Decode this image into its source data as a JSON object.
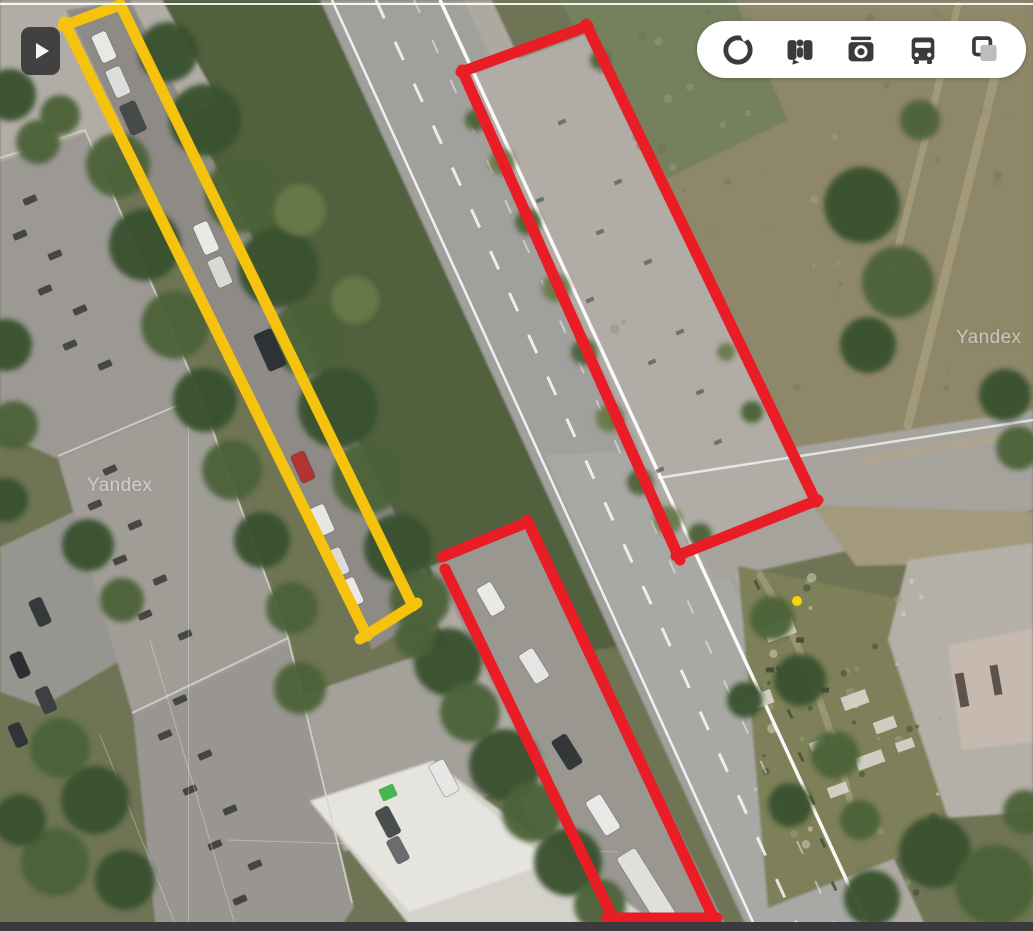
{
  "ui": {
    "play_button": {
      "name": "expand-panel-button",
      "x": 21,
      "y": 27
    },
    "toolbar": {
      "icons": [
        {
          "name": "panorama-ring-icon"
        },
        {
          "name": "street-view-icon"
        },
        {
          "name": "photos-camera-icon"
        },
        {
          "name": "transport-bus-icon"
        },
        {
          "name": "layers-icon"
        }
      ]
    },
    "watermarks": [
      {
        "text": "Yandex",
        "x": 87,
        "y": 475
      },
      {
        "text": "Yandex",
        "x": 956,
        "y": 327
      }
    ]
  },
  "annotations": {
    "stroke_width": 11,
    "yellow": "#f5c20e",
    "red": "#ea1c25",
    "rectangles": [
      {
        "id": "yellow-parking-strip",
        "color": "#f5c20e",
        "segments": [
          [
            63,
            26,
            120,
            5
          ],
          [
            120,
            4,
            413,
            606
          ],
          [
            417,
            603,
            360,
            639
          ],
          [
            64,
            22,
            367,
            636
          ]
        ]
      },
      {
        "id": "red-concrete-pad",
        "color": "#ea1c25",
        "segments": [
          [
            461,
            72,
            588,
            26
          ],
          [
            586,
            24,
            816,
            502
          ],
          [
            818,
            500,
            676,
            556
          ],
          [
            462,
            70,
            680,
            560
          ]
        ]
      },
      {
        "id": "red-roadside-parking",
        "color": "#ea1c25",
        "segments": [
          [
            442,
            557,
            528,
            522
          ],
          [
            527,
            520,
            714,
            919
          ],
          [
            717,
            918,
            607,
            918
          ],
          [
            445,
            569,
            613,
            918
          ]
        ]
      }
    ]
  },
  "scene": {
    "base": "#6e7454",
    "terrain": [
      {
        "name": "dry-field",
        "points": "575,0 1033,0 1033,435 820,507 660,175 585,30",
        "fill": "#8e8769"
      },
      {
        "name": "grass-top-mid",
        "points": "560,0 735,0 788,120 668,178 580,40",
        "fill": "#75805b"
      },
      {
        "name": "median-green",
        "points": "126,0 332,0 628,645 470,670 430,600",
        "fill": "#51613e"
      },
      {
        "name": "pavement-top-left",
        "points": "0,0 162,0 218,100 40,207 0,187",
        "fill": "#b1ada6"
      },
      {
        "name": "parking-lane",
        "points": "66,10 130,0 442,605 372,650",
        "fill": "#8e8b86"
      },
      {
        "name": "main-road",
        "points": "320,0 463,0 900,931 748,931",
        "fill": "#a0a09d"
      },
      {
        "name": "road-light",
        "points": "545,455 668,450 900,931 752,931",
        "fill": "#b2b2ae",
        "opacity": 0.45
      },
      {
        "name": "sidewalk-right",
        "points": "463,0 492,0 928,931 900,931",
        "fill": "#ada9a1"
      },
      {
        "name": "side-road",
        "points": "650,470 1033,410 1033,510 716,580",
        "fill": "#a6a39d"
      },
      {
        "name": "dirt-fork",
        "points": "812,505 1033,512 1033,562 856,566",
        "fill": "#a39a7e"
      },
      {
        "name": "rubble-zone",
        "points": "738,566 918,602 955,835 768,908",
        "fill": "#7d8059"
      },
      {
        "name": "pavement-right-bottom",
        "points": "908,560 1033,543 1033,812 948,818 888,640",
        "fill": "#b4b0a7"
      },
      {
        "name": "building-bottom-right",
        "points": "948,645 1033,628 1033,742 962,750",
        "fill": "#c6bab0"
      },
      {
        "name": "pocket-parking",
        "points": "430,567 526,524 726,926 598,926",
        "fill": "#9a9791"
      },
      {
        "name": "footpath",
        "points": "418,582 436,573 614,926 580,926",
        "fill": "#b0aca4"
      },
      {
        "name": "apron",
        "points": "282,702 462,640 524,782 344,852",
        "fill": "#a4a19b"
      },
      {
        "name": "courtyard",
        "points": "0,547 86,506 152,642 42,707 0,692",
        "fill": "#97958f"
      },
      {
        "name": "building-left-1",
        "points": "0,162 86,133 202,399 58,459 0,432",
        "fill": "#9c9994"
      },
      {
        "name": "building-left-2",
        "points": "58,459 202,399 290,642 133,716",
        "fill": "#a09d97"
      },
      {
        "name": "building-left-3",
        "points": "133,716 290,642 354,907 338,931 156,931",
        "fill": "#999691"
      },
      {
        "name": "white-building",
        "points": "310,801 433,761 666,931 414,931",
        "fill": "#d5d2cb"
      },
      {
        "name": "white-building-highlight",
        "points": "310,801 433,761 549,863 409,912",
        "fill": "#e6e4de"
      },
      {
        "name": "concrete-pad",
        "points": "467,77 585,34 811,495 686,547",
        "fill": "#b1aca5"
      }
    ],
    "trims": [
      {
        "points": "0,158 85,130 200,396",
        "color": "#d8d5cf",
        "w": 2,
        "opacity": 0.8
      },
      {
        "points": "58,456 200,396 288,638",
        "color": "#d8d5cf",
        "w": 2,
        "opacity": 0.8
      },
      {
        "points": "132,713 288,638 352,903",
        "color": "#d8d5cf",
        "w": 2,
        "opacity": 0.8
      }
    ],
    "trails": [
      {
        "d": "M1008,25 C985,120 952,250 908,425",
        "w": 9
      },
      {
        "d": "M958,5 C938,85 918,175 885,295",
        "w": 7
      },
      {
        "d": "M862,462 C905,452 965,442 1033,434",
        "w": 9
      },
      {
        "d": "M760,575 C800,640 830,720 850,800",
        "w": 7
      }
    ],
    "trail_color": "#b2a887",
    "road_lines": [
      {
        "x1": 332,
        "y1": 0,
        "x2": 757,
        "y2": 931,
        "w": 2.5,
        "opacity": 0.85
      },
      {
        "x1": 376,
        "y1": 0,
        "x2": 800,
        "y2": 931,
        "w": 3,
        "dash": "20 26",
        "opacity": 0.8
      },
      {
        "x1": 440,
        "y1": 0,
        "x2": 870,
        "y2": 931,
        "w": 3.5,
        "opacity": 0.95
      },
      {
        "x1": 414,
        "y1": 0,
        "x2": 838,
        "y2": 931,
        "w": 2,
        "dash": "14 30",
        "opacity": 0.45
      },
      {
        "x1": 658,
        "y1": 478,
        "x2": 1033,
        "y2": 420,
        "w": 2.5,
        "opacity": 0.7
      }
    ],
    "wires": [
      [
        150,
        640,
        237,
        931
      ],
      [
        100,
        735,
        178,
        931
      ],
      [
        228,
        840,
        618,
        852
      ]
    ],
    "tree_tones": [
      "#39512f",
      "#4c6238",
      "#68794a"
    ],
    "trees": [
      [
        168,
        52,
        30,
        0
      ],
      [
        205,
        120,
        36,
        0
      ],
      [
        243,
        195,
        38,
        1
      ],
      [
        278,
        268,
        40,
        0
      ],
      [
        308,
        338,
        38,
        1
      ],
      [
        338,
        408,
        40,
        0
      ],
      [
        368,
        478,
        36,
        1
      ],
      [
        398,
        548,
        34,
        0
      ],
      [
        420,
        600,
        30,
        1
      ],
      [
        300,
        210,
        26,
        2
      ],
      [
        355,
        300,
        24,
        2
      ],
      [
        118,
        165,
        32,
        1
      ],
      [
        145,
        245,
        36,
        0
      ],
      [
        175,
        325,
        34,
        1
      ],
      [
        205,
        400,
        32,
        0
      ],
      [
        232,
        470,
        30,
        1
      ],
      [
        262,
        540,
        28,
        0
      ],
      [
        292,
        608,
        26,
        1
      ],
      [
        10,
        95,
        26,
        0
      ],
      [
        38,
        142,
        22,
        1
      ],
      [
        60,
        115,
        20,
        1
      ],
      [
        6,
        345,
        26,
        0
      ],
      [
        14,
        425,
        24,
        1
      ],
      [
        6,
        500,
        22,
        0
      ],
      [
        88,
        545,
        26,
        0
      ],
      [
        122,
        600,
        22,
        1
      ],
      [
        60,
        748,
        30,
        1
      ],
      [
        95,
        800,
        34,
        0
      ],
      [
        55,
        862,
        34,
        1
      ],
      [
        125,
        880,
        30,
        0
      ],
      [
        20,
        820,
        26,
        0
      ],
      [
        300,
        688,
        26,
        1
      ],
      [
        448,
        662,
        34,
        0
      ],
      [
        470,
        712,
        30,
        1
      ],
      [
        505,
        765,
        36,
        0
      ],
      [
        532,
        812,
        30,
        1
      ],
      [
        568,
        862,
        34,
        0
      ],
      [
        600,
        905,
        26,
        1
      ],
      [
        415,
        638,
        20,
        1
      ],
      [
        862,
        205,
        38,
        0
      ],
      [
        898,
        282,
        36,
        1
      ],
      [
        868,
        345,
        28,
        0
      ],
      [
        920,
        120,
        20,
        1
      ],
      [
        1005,
        395,
        26,
        0
      ],
      [
        1018,
        448,
        22,
        1
      ],
      [
        502,
        162,
        13,
        2
      ],
      [
        528,
        222,
        13,
        1
      ],
      [
        556,
        288,
        14,
        2
      ],
      [
        584,
        352,
        13,
        1
      ],
      [
        610,
        418,
        14,
        2
      ],
      [
        640,
        482,
        13,
        1
      ],
      [
        668,
        520,
        14,
        2
      ],
      [
        700,
        535,
        12,
        1
      ],
      [
        600,
        60,
        10,
        1
      ],
      [
        476,
        120,
        11,
        1
      ],
      [
        752,
        412,
        11,
        1
      ],
      [
        726,
        352,
        9,
        2
      ],
      [
        772,
        618,
        22,
        1
      ],
      [
        800,
        680,
        26,
        0
      ],
      [
        835,
        755,
        24,
        1
      ],
      [
        790,
        805,
        22,
        0
      ],
      [
        860,
        820,
        20,
        1
      ],
      [
        745,
        700,
        18,
        0
      ],
      [
        935,
        852,
        36,
        0
      ],
      [
        995,
        885,
        40,
        1
      ],
      [
        872,
        898,
        28,
        0
      ],
      [
        1025,
        812,
        22,
        1
      ]
    ],
    "cars": [
      [
        104,
        47,
        16,
        30,
        "#e8e8e6",
        -24
      ],
      [
        118,
        82,
        16,
        30,
        "#dddddb",
        -24
      ],
      [
        133,
        118,
        17,
        32,
        "#474a4b",
        -24
      ],
      [
        206,
        238,
        16,
        32,
        "#e9e9e7",
        -24
      ],
      [
        220,
        272,
        16,
        30,
        "#d8d8d5",
        -24
      ],
      [
        270,
        350,
        19,
        40,
        "#2e3234",
        -24
      ],
      [
        303,
        467,
        15,
        30,
        "#b23430",
        -24
      ],
      [
        322,
        520,
        16,
        30,
        "#e6e6e4",
        -24
      ],
      [
        338,
        562,
        15,
        28,
        "#dcdcda",
        -24
      ],
      [
        352,
        592,
        15,
        28,
        "#e8e8e6",
        -24
      ],
      [
        491,
        599,
        17,
        32,
        "#e9e9e7",
        -30
      ],
      [
        534,
        666,
        17,
        34,
        "#e5e5e3",
        -32
      ],
      [
        567,
        752,
        17,
        34,
        "#33373a",
        -32
      ],
      [
        603,
        815,
        18,
        40,
        "#e9e9e8",
        -32
      ],
      [
        646,
        886,
        22,
        78,
        "#dfdfdc",
        -32
      ],
      [
        444,
        778,
        17,
        36,
        "#e7e7e5",
        -28
      ],
      [
        40,
        612,
        14,
        28,
        "#35393b",
        -24
      ],
      [
        20,
        665,
        13,
        26,
        "#2b2f31",
        -24
      ],
      [
        46,
        700,
        14,
        26,
        "#3c4043",
        -24
      ],
      [
        18,
        735,
        13,
        24,
        "#303436",
        -24
      ],
      [
        388,
        822,
        15,
        30,
        "#4a4e50",
        -28
      ],
      [
        398,
        850,
        14,
        26,
        "#6a6d6e",
        -28
      ]
    ],
    "vents": [
      [
        30,
        200
      ],
      [
        55,
        255
      ],
      [
        80,
        310
      ],
      [
        105,
        365
      ],
      [
        20,
        235
      ],
      [
        45,
        290
      ],
      [
        70,
        345
      ],
      [
        110,
        470
      ],
      [
        135,
        525
      ],
      [
        160,
        580
      ],
      [
        185,
        635
      ],
      [
        95,
        505
      ],
      [
        120,
        560
      ],
      [
        145,
        615
      ],
      [
        180,
        700
      ],
      [
        205,
        755
      ],
      [
        230,
        810
      ],
      [
        255,
        865
      ],
      [
        165,
        735
      ],
      [
        190,
        790
      ],
      [
        215,
        845
      ],
      [
        240,
        900
      ]
    ],
    "pad_marks": [
      [
        562,
        122
      ],
      [
        618,
        182
      ],
      [
        600,
        232
      ],
      [
        648,
        262
      ],
      [
        590,
        300
      ],
      [
        652,
        362
      ],
      [
        680,
        332
      ],
      [
        700,
        392
      ],
      [
        718,
        442
      ],
      [
        540,
        200
      ],
      [
        660,
        470
      ],
      [
        620,
        420
      ]
    ],
    "fence_ticks": [
      [
        757,
        585
      ],
      [
        768,
        628
      ],
      [
        779,
        671
      ],
      [
        790,
        714
      ],
      [
        801,
        757
      ],
      [
        812,
        800
      ],
      [
        823,
        843
      ],
      [
        834,
        886
      ]
    ],
    "debris_light": [
      [
        855,
        700,
        26,
        14
      ],
      [
        885,
        725,
        22,
        12
      ],
      [
        870,
        760,
        28,
        13
      ],
      [
        905,
        745,
        18,
        10
      ],
      [
        838,
        790,
        20,
        11
      ],
      [
        818,
        745,
        16,
        9
      ],
      [
        780,
        630,
        30,
        16
      ],
      [
        760,
        700,
        26,
        14
      ]
    ],
    "debris_dark": [
      [
        800,
        640
      ],
      [
        770,
        670
      ],
      [
        825,
        690
      ]
    ],
    "building_br_slots": [
      [
        962,
        690,
        9,
        34
      ],
      [
        996,
        680,
        8,
        30
      ]
    ],
    "dumpster": {
      "x": 380,
      "y": 786,
      "w": 16,
      "h": 13,
      "fill": "#46b554",
      "angle": -24
    },
    "yellow_dot": {
      "cx": 797,
      "cy": 601,
      "r": 5,
      "fill": "#f7d308"
    },
    "speckle_zones": [
      {
        "x": 585,
        "y": 5,
        "w": 445,
        "h": 415,
        "n": 70,
        "colors": [
          "#6e6a4e",
          "#b5ac8d",
          "#7c8160"
        ],
        "opacity": 0.3
      },
      {
        "x": 745,
        "y": 575,
        "w": 200,
        "h": 320,
        "n": 45,
        "colors": [
          "#d9d5c9",
          "#3d4136",
          "#9aa07b"
        ],
        "opacity": 0.5
      }
    ]
  }
}
